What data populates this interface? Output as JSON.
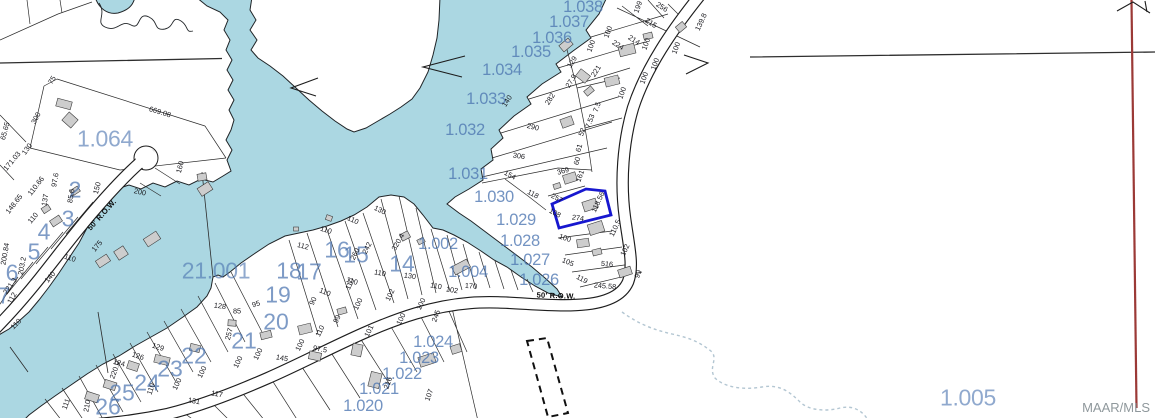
{
  "watermark": "MAAR/MLS",
  "colors": {
    "water": "#abd7e2",
    "labelblue": "#4d76b1",
    "highlight": "#1717cf",
    "redline": "#9b3936",
    "building": "#cdcdcd",
    "stream": "#b3c6d2"
  },
  "labels": [
    {
      "t": "1.064",
      "x": 105,
      "y": 139,
      "type": "big",
      "r": 0
    },
    {
      "t": "21.001",
      "x": 216,
      "y": 271,
      "type": "big",
      "r": 0
    },
    {
      "t": "1.005",
      "x": 968,
      "y": 398,
      "type": "big",
      "r": 0
    },
    {
      "t": "1.038",
      "x": 583,
      "y": 7,
      "type": "parcel",
      "r": 0
    },
    {
      "t": "1.037",
      "x": 569,
      "y": 22,
      "type": "parcel",
      "r": 0
    },
    {
      "t": "1.036",
      "x": 552,
      "y": 38,
      "type": "parcel",
      "r": 0
    },
    {
      "t": "1.035",
      "x": 531,
      "y": 52,
      "type": "parcel",
      "r": 0
    },
    {
      "t": "1.034",
      "x": 502,
      "y": 70,
      "type": "parcel",
      "r": 0
    },
    {
      "t": "1.033",
      "x": 486,
      "y": 99,
      "type": "parcel",
      "r": 0
    },
    {
      "t": "1.032",
      "x": 465,
      "y": 130,
      "type": "parcel",
      "r": 0
    },
    {
      "t": "1.031",
      "x": 468,
      "y": 174,
      "type": "parcel",
      "r": 0
    },
    {
      "t": "1.030",
      "x": 494,
      "y": 197,
      "type": "parcel",
      "r": 0
    },
    {
      "t": "1.029",
      "x": 516,
      "y": 220,
      "type": "parcel",
      "r": 0
    },
    {
      "t": "1.028",
      "x": 520,
      "y": 241,
      "type": "parcel",
      "r": 0
    },
    {
      "t": "1.027",
      "x": 530,
      "y": 260,
      "type": "parcel",
      "r": 0
    },
    {
      "t": "1.026",
      "x": 539,
      "y": 280,
      "type": "parcel",
      "r": 0
    },
    {
      "t": "1.002",
      "x": 438,
      "y": 244,
      "type": "parcel",
      "r": 0
    },
    {
      "t": "1.004",
      "x": 468,
      "y": 272,
      "type": "parcel",
      "r": 0
    },
    {
      "t": "1.024",
      "x": 433,
      "y": 342,
      "type": "parcel",
      "r": 0
    },
    {
      "t": "1.023",
      "x": 419,
      "y": 358,
      "type": "parcel",
      "r": 0
    },
    {
      "t": "1.022",
      "x": 402,
      "y": 374,
      "type": "parcel",
      "r": 0
    },
    {
      "t": "1.021",
      "x": 379,
      "y": 389,
      "type": "parcel",
      "r": 0
    },
    {
      "t": "1.020",
      "x": 363,
      "y": 406,
      "type": "parcel",
      "r": 0
    },
    {
      "t": "2",
      "x": 75,
      "y": 190,
      "type": "lot",
      "r": 0
    },
    {
      "t": "3",
      "x": 68,
      "y": 219,
      "type": "lot",
      "r": 0
    },
    {
      "t": "4",
      "x": 44,
      "y": 232,
      "type": "lot",
      "r": 0
    },
    {
      "t": "5",
      "x": 34,
      "y": 252,
      "type": "lot",
      "r": 0
    },
    {
      "t": "6",
      "x": 12,
      "y": 273,
      "type": "lot",
      "r": 0
    },
    {
      "t": "7",
      "x": 4,
      "y": 296,
      "type": "lot",
      "r": 0
    },
    {
      "t": "14",
      "x": 402,
      "y": 264,
      "type": "lot",
      "r": 0
    },
    {
      "t": "15",
      "x": 356,
      "y": 255,
      "type": "lot",
      "r": 0
    },
    {
      "t": "16",
      "x": 337,
      "y": 250,
      "type": "lot",
      "r": 0
    },
    {
      "t": "17",
      "x": 309,
      "y": 272,
      "type": "lot",
      "r": 0
    },
    {
      "t": "18",
      "x": 289,
      "y": 271,
      "type": "lot",
      "r": 0
    },
    {
      "t": "19",
      "x": 278,
      "y": 295,
      "type": "lot",
      "r": 0
    },
    {
      "t": "20",
      "x": 276,
      "y": 322,
      "type": "lot",
      "r": 0
    },
    {
      "t": "21",
      "x": 244,
      "y": 341,
      "type": "lot",
      "r": 0
    },
    {
      "t": "22",
      "x": 194,
      "y": 356,
      "type": "lot",
      "r": 0
    },
    {
      "t": "23",
      "x": 170,
      "y": 369,
      "type": "lot",
      "r": 0
    },
    {
      "t": "24",
      "x": 147,
      "y": 383,
      "type": "lot",
      "r": 0
    },
    {
      "t": "25",
      "x": 122,
      "y": 393,
      "type": "lot",
      "r": 0
    },
    {
      "t": "26",
      "x": 108,
      "y": 407,
      "type": "lot",
      "r": 0
    },
    {
      "t": "669.08",
      "x": 160,
      "y": 112,
      "type": "dim",
      "r": 17
    },
    {
      "t": "300",
      "x": 36,
      "y": 118,
      "type": "dim",
      "r": -62
    },
    {
      "t": "75",
      "x": 52,
      "y": 80,
      "type": "dim",
      "r": -58
    },
    {
      "t": "130",
      "x": 27,
      "y": 149,
      "type": "dim",
      "r": -55
    },
    {
      "t": "171.03",
      "x": 12,
      "y": 161,
      "type": "dim",
      "r": -50
    },
    {
      "t": "65.65",
      "x": 5,
      "y": 131,
      "type": "dim",
      "r": -75
    },
    {
      "t": "110.66",
      "x": 36,
      "y": 186,
      "type": "dim",
      "r": -52
    },
    {
      "t": "148.65",
      "x": 14,
      "y": 204,
      "type": "dim",
      "r": -52
    },
    {
      "t": "97.6",
      "x": 55,
      "y": 180,
      "type": "dim",
      "r": -80
    },
    {
      "t": "137",
      "x": 45,
      "y": 200,
      "type": "dim",
      "r": -80
    },
    {
      "t": "110",
      "x": 33,
      "y": 218,
      "type": "dim",
      "r": -50
    },
    {
      "t": "85.6",
      "x": 71,
      "y": 196,
      "type": "dim",
      "r": -80
    },
    {
      "t": "150",
      "x": 97,
      "y": 188,
      "type": "dim",
      "r": -75
    },
    {
      "t": "175",
      "x": 97,
      "y": 246,
      "type": "dim",
      "r": -50
    },
    {
      "t": "110",
      "x": 70,
      "y": 258,
      "type": "dim",
      "r": 18
    },
    {
      "t": "140",
      "x": 50,
      "y": 277,
      "type": "dim",
      "r": -50
    },
    {
      "t": "112",
      "x": 12,
      "y": 298,
      "type": "dim",
      "r": -60
    },
    {
      "t": "221.3",
      "x": 10,
      "y": 286,
      "type": "dim",
      "r": -55
    },
    {
      "t": "110",
      "x": 16,
      "y": 324,
      "type": "dim",
      "r": -45
    },
    {
      "t": "203.2",
      "x": 22,
      "y": 266,
      "type": "dim",
      "r": -80
    },
    {
      "t": "200.84",
      "x": 5,
      "y": 254,
      "type": "dim",
      "r": -80
    },
    {
      "t": "200",
      "x": 140,
      "y": 192,
      "type": "dim",
      "r": 12
    },
    {
      "t": "160",
      "x": 180,
      "y": 167,
      "type": "dim",
      "r": -75
    },
    {
      "t": "199",
      "x": 638,
      "y": 7,
      "type": "dim",
      "r": -70
    },
    {
      "t": "256",
      "x": 662,
      "y": 7,
      "type": "dim",
      "r": 32
    },
    {
      "t": "215",
      "x": 651,
      "y": 23,
      "type": "dim",
      "r": 32
    },
    {
      "t": "139.8",
      "x": 701,
      "y": 22,
      "type": "dim",
      "r": -65
    },
    {
      "t": "100",
      "x": 608,
      "y": 32,
      "type": "dim",
      "r": -70
    },
    {
      "t": "100",
      "x": 646,
      "y": 44,
      "type": "dim",
      "r": -70
    },
    {
      "t": "100",
      "x": 676,
      "y": 48,
      "type": "dim",
      "r": -70
    },
    {
      "t": "214",
      "x": 634,
      "y": 40,
      "type": "dim",
      "r": 32
    },
    {
      "t": "224",
      "x": 618,
      "y": 45,
      "type": "dim",
      "r": 32
    },
    {
      "t": "221",
      "x": 596,
      "y": 71,
      "type": "dim",
      "r": -58
    },
    {
      "t": "100",
      "x": 591,
      "y": 46,
      "type": "dim",
      "r": -70
    },
    {
      "t": "129",
      "x": 572,
      "y": 62,
      "type": "dim",
      "r": -58
    },
    {
      "t": "27.9",
      "x": 571,
      "y": 81,
      "type": "dim",
      "r": -58
    },
    {
      "t": "282",
      "x": 550,
      "y": 99,
      "type": "dim",
      "r": -58
    },
    {
      "t": "140",
      "x": 507,
      "y": 101,
      "type": "dim",
      "r": -58
    },
    {
      "t": "100",
      "x": 655,
      "y": 64,
      "type": "dim",
      "r": -70
    },
    {
      "t": "100",
      "x": 644,
      "y": 78,
      "type": "dim",
      "r": -70
    },
    {
      "t": "100",
      "x": 622,
      "y": 93,
      "type": "dim",
      "r": -70
    },
    {
      "t": "7.5",
      "x": 597,
      "y": 107,
      "type": "dim",
      "r": -70
    },
    {
      "t": "7.53",
      "x": 590,
      "y": 121,
      "type": "dim",
      "r": -70
    },
    {
      "t": "52",
      "x": 582,
      "y": 132,
      "type": "dim",
      "r": -70
    },
    {
      "t": "61",
      "x": 579,
      "y": 148,
      "type": "dim",
      "r": -75
    },
    {
      "t": "60",
      "x": 577,
      "y": 161,
      "type": "dim",
      "r": -75
    },
    {
      "t": "290",
      "x": 533,
      "y": 127,
      "type": "dim",
      "r": 14
    },
    {
      "t": "306",
      "x": 519,
      "y": 156,
      "type": "dim",
      "r": 8
    },
    {
      "t": "154",
      "x": 510,
      "y": 175,
      "type": "dim",
      "r": 28
    },
    {
      "t": "118",
      "x": 533,
      "y": 194,
      "type": "dim",
      "r": 28
    },
    {
      "t": "369",
      "x": 563,
      "y": 171,
      "type": "dim",
      "r": -15
    },
    {
      "t": "161",
      "x": 580,
      "y": 176,
      "type": "dim",
      "r": -70
    },
    {
      "t": "257",
      "x": 557,
      "y": 198,
      "type": "dim",
      "r": 28
    },
    {
      "t": "118.56",
      "x": 598,
      "y": 202,
      "type": "dim",
      "r": -65
    },
    {
      "t": "108",
      "x": 555,
      "y": 213,
      "type": "dim",
      "r": 28
    },
    {
      "t": "274",
      "x": 578,
      "y": 218,
      "type": "dim",
      "r": 8
    },
    {
      "t": "110.5",
      "x": 615,
      "y": 228,
      "type": "dim",
      "r": -65
    },
    {
      "t": "100",
      "x": 565,
      "y": 238,
      "type": "dim",
      "r": 18
    },
    {
      "t": "105",
      "x": 568,
      "y": 262,
      "type": "dim",
      "r": 22
    },
    {
      "t": "119",
      "x": 582,
      "y": 279,
      "type": "dim",
      "r": 28
    },
    {
      "t": "516",
      "x": 607,
      "y": 264,
      "type": "dim",
      "r": 6
    },
    {
      "t": "102",
      "x": 625,
      "y": 250,
      "type": "dim",
      "r": -65
    },
    {
      "t": "99",
      "x": 638,
      "y": 274,
      "type": "dim",
      "r": -70
    },
    {
      "t": "245.58",
      "x": 605,
      "y": 286,
      "type": "dim",
      "r": 5
    },
    {
      "t": "128",
      "x": 220,
      "y": 306,
      "type": "dim",
      "r": 8
    },
    {
      "t": "85",
      "x": 237,
      "y": 311,
      "type": "dim",
      "r": 0
    },
    {
      "t": "257",
      "x": 229,
      "y": 334,
      "type": "dim",
      "r": -75
    },
    {
      "t": "95",
      "x": 256,
      "y": 304,
      "type": "dim",
      "r": -18
    },
    {
      "t": "129",
      "x": 158,
      "y": 347,
      "type": "dim",
      "r": 18
    },
    {
      "t": "126",
      "x": 138,
      "y": 356,
      "type": "dim",
      "r": 18
    },
    {
      "t": "124",
      "x": 119,
      "y": 363,
      "type": "dim",
      "r": 14
    },
    {
      "t": "110",
      "x": 151,
      "y": 389,
      "type": "dim",
      "r": -70
    },
    {
      "t": "100",
      "x": 177,
      "y": 384,
      "type": "dim",
      "r": -65
    },
    {
      "t": "100",
      "x": 202,
      "y": 372,
      "type": "dim",
      "r": -65
    },
    {
      "t": "117",
      "x": 217,
      "y": 394,
      "type": "dim",
      "r": 10
    },
    {
      "t": "131",
      "x": 194,
      "y": 401,
      "type": "dim",
      "r": 10
    },
    {
      "t": "111",
      "x": 66,
      "y": 404,
      "type": "dim",
      "r": -70
    },
    {
      "t": "210",
      "x": 87,
      "y": 406,
      "type": "dim",
      "r": -80
    },
    {
      "t": "220.9",
      "x": 115,
      "y": 370,
      "type": "dim",
      "r": -70
    },
    {
      "t": "100",
      "x": 238,
      "y": 362,
      "type": "dim",
      "r": -65
    },
    {
      "t": "100",
      "x": 258,
      "y": 354,
      "type": "dim",
      "r": -65
    },
    {
      "t": "145",
      "x": 282,
      "y": 358,
      "type": "dim",
      "r": 10
    },
    {
      "t": "100",
      "x": 300,
      "y": 345,
      "type": "dim",
      "r": -65
    },
    {
      "t": "110",
      "x": 320,
      "y": 331,
      "type": "dim",
      "r": -65
    },
    {
      "t": "99",
      "x": 337,
      "y": 319,
      "type": "dim",
      "r": -65
    },
    {
      "t": "100",
      "x": 358,
      "y": 304,
      "type": "dim",
      "r": -65
    },
    {
      "t": "101",
      "x": 369,
      "y": 331,
      "type": "dim",
      "r": -65
    },
    {
      "t": "97.5",
      "x": 320,
      "y": 349,
      "type": "dim",
      "r": 10
    },
    {
      "t": "102",
      "x": 390,
      "y": 295,
      "type": "dim",
      "r": -65
    },
    {
      "t": "110",
      "x": 350,
      "y": 284,
      "type": "dim",
      "r": -65
    },
    {
      "t": "90",
      "x": 313,
      "y": 301,
      "type": "dim",
      "r": -65
    },
    {
      "t": "100",
      "x": 401,
      "y": 319,
      "type": "dim",
      "r": -65
    },
    {
      "t": "100",
      "x": 421,
      "y": 304,
      "type": "dim",
      "r": -65
    },
    {
      "t": "245",
      "x": 436,
      "y": 316,
      "type": "dim",
      "r": -70
    },
    {
      "t": "216",
      "x": 388,
      "y": 383,
      "type": "dim",
      "r": -70
    },
    {
      "t": "110",
      "x": 436,
      "y": 286,
      "type": "dim",
      "r": 10
    },
    {
      "t": "102",
      "x": 452,
      "y": 290,
      "type": "dim",
      "r": 10
    },
    {
      "t": "107",
      "x": 429,
      "y": 395,
      "type": "dim",
      "r": -70
    },
    {
      "t": "170",
      "x": 471,
      "y": 286,
      "type": "dim",
      "r": 4
    },
    {
      "t": "130",
      "x": 410,
      "y": 276,
      "type": "dim",
      "r": 8
    },
    {
      "t": "110",
      "x": 380,
      "y": 273,
      "type": "dim",
      "r": 10
    },
    {
      "t": "110",
      "x": 352,
      "y": 281,
      "type": "dim",
      "r": 18
    },
    {
      "t": "110",
      "x": 325,
      "y": 292,
      "type": "dim",
      "r": 22
    },
    {
      "t": "112",
      "x": 303,
      "y": 246,
      "type": "dim",
      "r": 14
    },
    {
      "t": "110",
      "x": 326,
      "y": 230,
      "type": "dim",
      "r": 18
    },
    {
      "t": "110",
      "x": 353,
      "y": 220,
      "type": "dim",
      "r": 24
    },
    {
      "t": "130",
      "x": 380,
      "y": 210,
      "type": "dim",
      "r": 26
    },
    {
      "t": "320.4",
      "x": 398,
      "y": 242,
      "type": "dim",
      "r": -60
    },
    {
      "t": "242",
      "x": 367,
      "y": 248,
      "type": "dim",
      "r": -63
    },
    {
      "t": "260",
      "x": 355,
      "y": 254,
      "type": "dim",
      "r": -63
    },
    {
      "t": "50' R.O.W.",
      "x": 556,
      "y": 296,
      "type": "row",
      "r": 2
    },
    {
      "t": "50' R.O.W.",
      "x": 102,
      "y": 215,
      "type": "row",
      "r": -48
    }
  ]
}
